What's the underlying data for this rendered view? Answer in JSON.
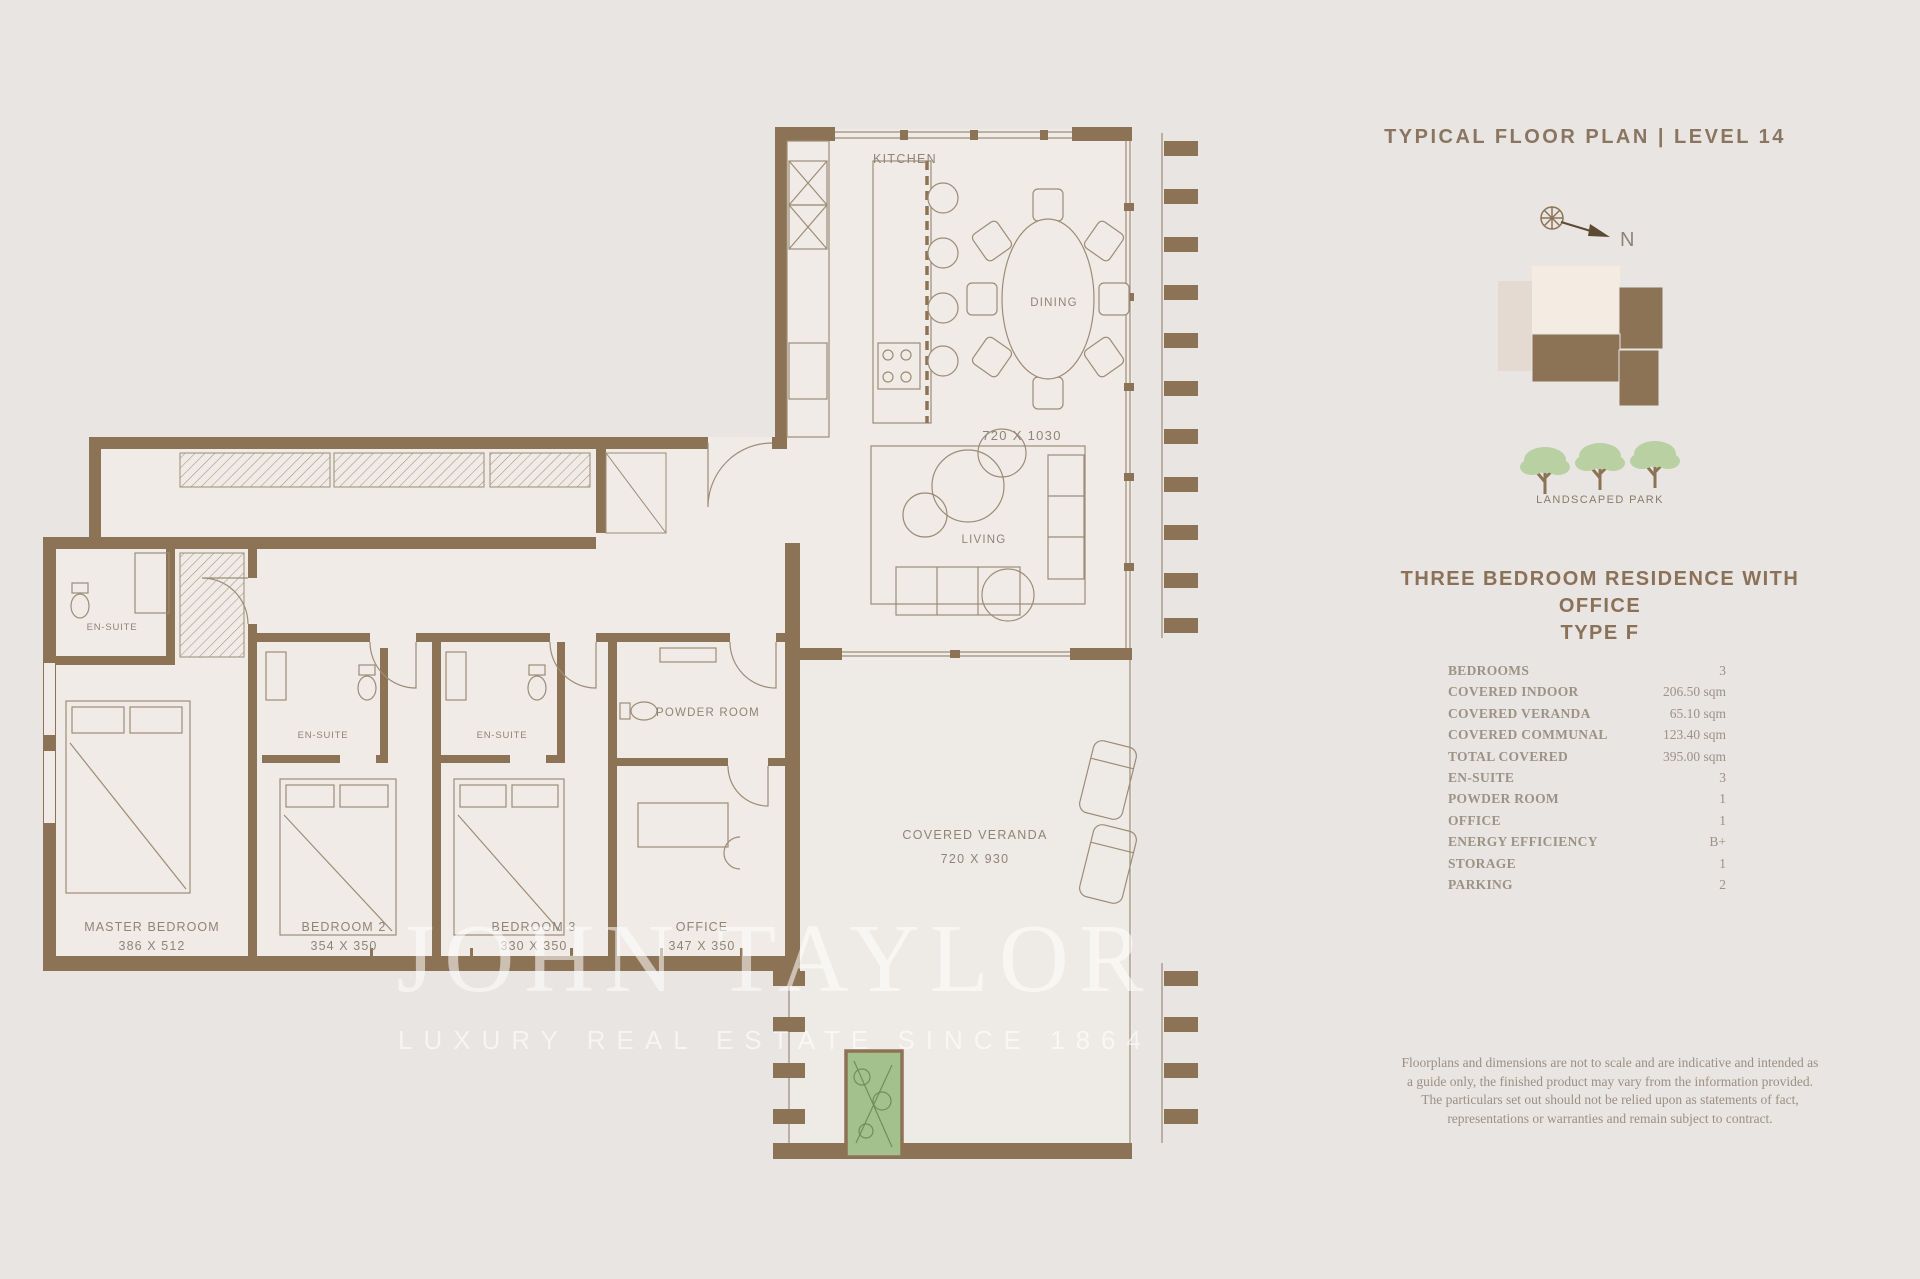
{
  "header": {
    "title": "TYPICAL FLOOR PLAN | LEVEL 14"
  },
  "keyplan": {
    "compass_label": "N",
    "park_label": "LANDSCAPED PARK"
  },
  "residence": {
    "title_line1": "THREE BEDROOM RESIDENCE WITH OFFICE",
    "title_line2": "TYPE F"
  },
  "specs": [
    {
      "label": "BEDROOMS",
      "value": "3"
    },
    {
      "label": "COVERED INDOOR",
      "value": "206.50 sqm"
    },
    {
      "label": "COVERED VERANDA",
      "value": "65.10 sqm"
    },
    {
      "label": "COVERED COMMUNAL",
      "value": "123.40 sqm"
    },
    {
      "label": "TOTAL COVERED",
      "value": "395.00 sqm"
    },
    {
      "label": "EN-SUITE",
      "value": "3"
    },
    {
      "label": "POWDER ROOM",
      "value": "1"
    },
    {
      "label": "OFFICE",
      "value": "1"
    },
    {
      "label": "ENERGY EFFICIENCY",
      "value": "B+"
    },
    {
      "label": "STORAGE",
      "value": "1"
    },
    {
      "label": "PARKING",
      "value": "2"
    }
  ],
  "disclaimer": "Floorplans and dimensions are not to scale and are indicative and intended as a guide only, the finished product may vary from the information provided. The particulars set out should not be relied upon as statements of fact, representations or warranties and remain subject to contract.",
  "rooms": {
    "kitchen": {
      "label": "KITCHEN"
    },
    "dining": {
      "label": "DINING",
      "dims": "720 X 1030"
    },
    "living": {
      "label": "LIVING"
    },
    "veranda": {
      "label": "COVERED VERANDA",
      "dims": "720 X 930"
    },
    "master_bedroom": {
      "label": "MASTER BEDROOM",
      "dims": "386 X 512"
    },
    "bedroom2": {
      "label": "BEDROOM 2",
      "dims": "354 X 350"
    },
    "bedroom3": {
      "label": "BEDROOM 3",
      "dims": "330 X 350"
    },
    "office": {
      "label": "OFFICE",
      "dims": "347 X 350"
    },
    "powder_room": {
      "label": "POWDER ROOM"
    },
    "ensuite_master": {
      "label": "EN-SUITE"
    },
    "ensuite_2": {
      "label": "EN-SUITE"
    },
    "ensuite_3": {
      "label": "EN-SUITE"
    }
  },
  "watermark": {
    "line1": "JOHN TAYLOR",
    "line2": "LUXURY REAL ESTATE SINCE 1864"
  },
  "colors": {
    "background": "#e8e5e2",
    "floor": "#f0ebe6",
    "wall": "#8d7355",
    "thin_line": "#9d8c77",
    "accent_text": "#8a7158",
    "table_text": "#9c9286",
    "tree_foliage": "#b9d0a2",
    "planter_green": "#a3c18d",
    "keyplan_cream": "#f4ebe2",
    "keyplan_pale": "#e5dad2",
    "watermark": "rgba(255,255,255,0.55)"
  }
}
